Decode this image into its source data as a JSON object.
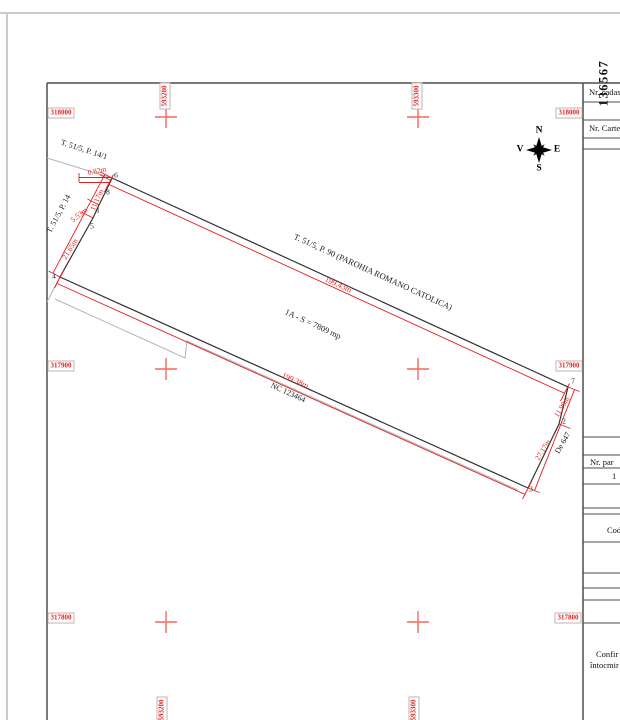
{
  "map": {
    "compass": {
      "n": "N",
      "e": "E",
      "s": "S",
      "v": "V"
    },
    "grid": {
      "northings": [
        "318000",
        "317900",
        "317800"
      ],
      "eastings": [
        "593200",
        "593300"
      ]
    },
    "labels": {
      "neighbor_nw": "T. 51/5, P. 14/1",
      "neighbor_w": "T. 51/5, P. 14",
      "neighbor_n": "T. 51/5, P. 90 (PAROHIA ROMANO CATOLICA)",
      "parcel_area": "1A - S = 7809 mp",
      "nc_number": "NC 123464",
      "road": "De 647"
    },
    "dimensions": {
      "top": "199.43m",
      "bottom": "199.38m",
      "west": [
        "0.82m",
        "11.17m",
        "5.53m",
        "21.65m"
      ],
      "east": [
        "11.99m",
        "27.17m"
      ]
    },
    "points": {
      "p1": "1",
      "p2": "2",
      "p3": "3",
      "p4": "4",
      "p5": "5",
      "p6": "6",
      "p7": "7",
      "p8": "8"
    }
  },
  "panel": {
    "vertical_number": "136567",
    "rows": {
      "nr_cadastral": "Nr. cadas",
      "nr_carte": "Nr. Carte",
      "nr_parcela": "Nr. par",
      "parcela_value": "1",
      "cod": "Cod",
      "confirm_line1": "Confir",
      "confirm_line2": "întocmir"
    }
  },
  "colors": {
    "dimension_red": "#e01f1f",
    "grid_cross_red": "#f4695f",
    "boundary_black": "#333333",
    "neighbor_gray": "#b5b5b5"
  }
}
